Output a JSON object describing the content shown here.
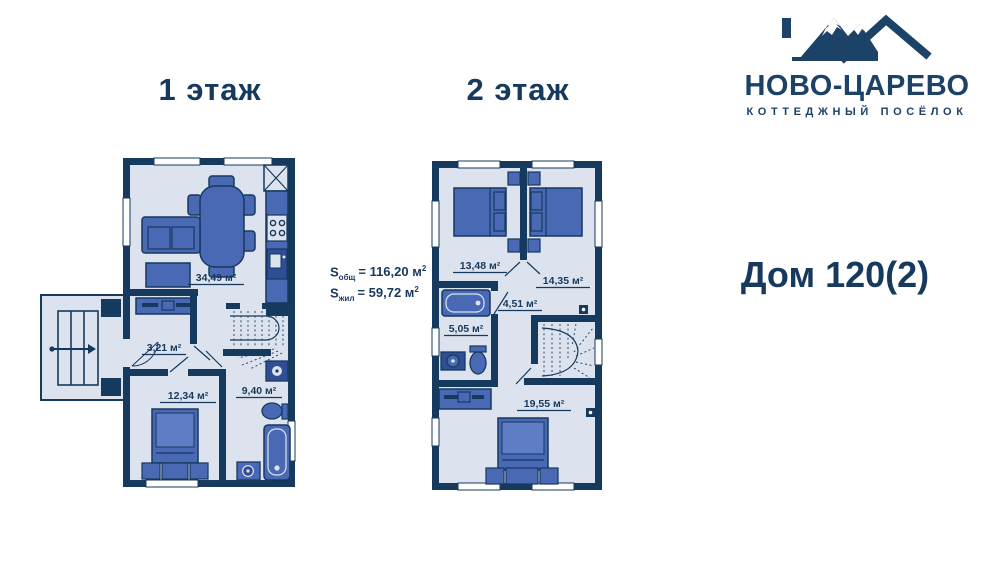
{
  "logo": {
    "title": "НОВО-ЦАРЕВО",
    "subtitle": "КОТТЕДЖНЫЙ ПОСЁЛОК",
    "icon": "mountains-roof-icon"
  },
  "house": {
    "title": "Дом 120(2)"
  },
  "area_summary": {
    "total": {
      "prefix": "S",
      "sub": "общ",
      "value": "= 116,20 м",
      "sup": "2"
    },
    "living": {
      "prefix": "S",
      "sub": "жил",
      "value": "= 59,72 м",
      "sup": "2"
    }
  },
  "floor1": {
    "heading": "1 этаж",
    "rooms": {
      "living": "34,49 м²",
      "hall": "3,21 м²",
      "bedroom": "12,34 м²",
      "bath": "9,40 м²"
    }
  },
  "floor2": {
    "heading": "2 этаж",
    "rooms": {
      "bedroom_left": "13,48 м²",
      "bedroom_right": "14,35 м²",
      "hall": "4,51 м²",
      "bath": "5,05 м²",
      "bedroom_big": "19,55 м²"
    }
  },
  "colors": {
    "navy": "#16395E",
    "floor": "#DCE3EE",
    "furniture": "#4A69B5",
    "furniture_dark": "#2F4E96",
    "white": "#FFFFFF"
  }
}
